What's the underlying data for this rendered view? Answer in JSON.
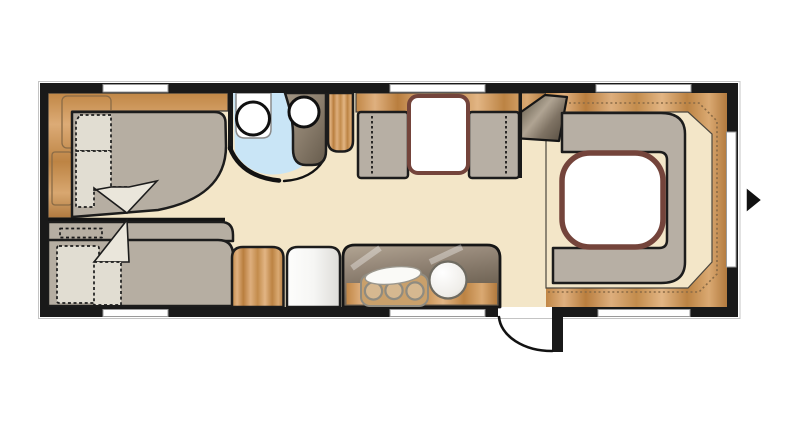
{
  "diagram": {
    "kind": "caravan-floor-plan",
    "view": "top-down",
    "rooms": [
      {
        "name": "bedroom",
        "furniture": [
          "single-bed",
          "bunk-beds",
          "overhead-lockers"
        ]
      },
      {
        "name": "washroom",
        "furniture": [
          "vanity-unit",
          "washbasin",
          "toilet"
        ]
      },
      {
        "name": "dinette",
        "furniture": [
          "bench-seat-left",
          "bench-seat-right",
          "dinette-table"
        ]
      },
      {
        "name": "kitchen",
        "furniture": [
          "worktop",
          "hob-3-burner",
          "round-sink",
          "wardrobe",
          "refrigerator"
        ]
      },
      {
        "name": "rear-lounge",
        "furniture": [
          "u-shaped-sofa",
          "lounge-table",
          "wrap-around-sideboard"
        ]
      }
    ],
    "windows": {
      "top_wall": 3,
      "bottom_wall": 3,
      "right_wall": 1
    },
    "doors": {
      "entry_door": "bottom-right, swing arc shown",
      "washroom_door": "curved partition with opening"
    },
    "entrance_arrow": "right side, pointing right"
  },
  "palette": {
    "background": "#ffffff",
    "wall": "#191919",
    "outer_outline": "#c4c4c4",
    "floor": "#f3e6c8",
    "window": "#ffffff",
    "mattress": "#b6aea2",
    "bedding": "#e1ddd2",
    "bedding_bright": "#eae6db",
    "seat": "#b7afa4",
    "bathroom_floor": "#c9e5f6",
    "fixture_white": "#ffffff",
    "table_top": "#ffffff",
    "table_border": "#74443b",
    "hob_plate": "#c9a06b",
    "wood_light": "#e0b181",
    "wood_mid": "#c68e50",
    "wood_dark": "#a87134",
    "counter_dark": "#6d6152",
    "counter_light": "#a89a89",
    "arrow": "#111111"
  }
}
